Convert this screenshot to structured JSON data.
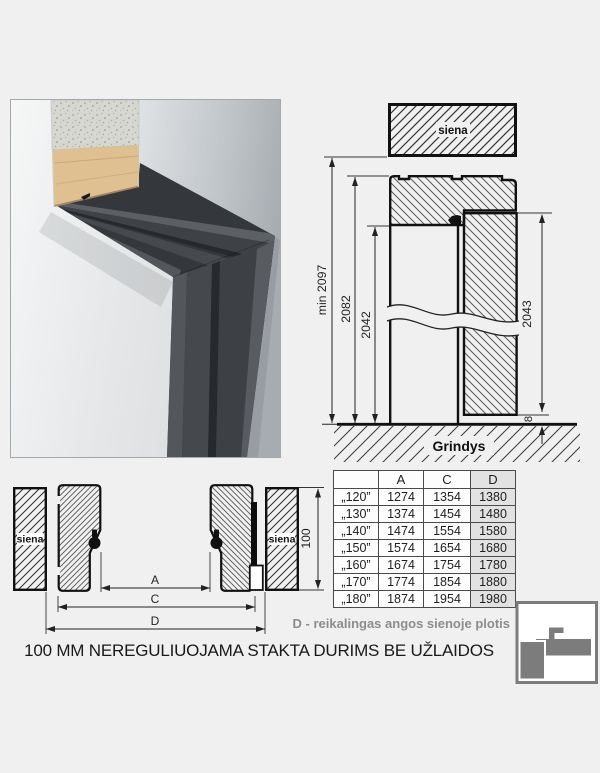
{
  "top_drawing": {
    "wall_label": "siena",
    "floor_label": "Grindys",
    "dim_min_height": "min 2097",
    "dim_frame_height": "2082",
    "dim_opening_height": "2042",
    "dim_leaf_height": "2043",
    "dim_floor_gap": "8"
  },
  "bottom_drawing": {
    "wall_label_left": "siena",
    "wall_label_right": "siena",
    "dim_a": "A",
    "dim_c": "C",
    "dim_d": "D",
    "dim_depth": "100"
  },
  "table": {
    "headers": [
      "",
      "A",
      "C",
      "D"
    ],
    "rows": [
      [
        "„120”",
        "1274",
        "1354",
        "1380"
      ],
      [
        "„130”",
        "1374",
        "1454",
        "1480"
      ],
      [
        "„140”",
        "1474",
        "1554",
        "1580"
      ],
      [
        "„150”",
        "1574",
        "1654",
        "1680"
      ],
      [
        "„160”",
        "1674",
        "1754",
        "1780"
      ],
      [
        "„170”",
        "1774",
        "1854",
        "1880"
      ],
      [
        "„180”",
        "1874",
        "1954",
        "1980"
      ]
    ]
  },
  "captions": {
    "d_note": "D - reikalingas angos sienoje plotis",
    "main": "100 MM NEREGULIUOJAMA STAKTA DURIMS BE UŽLAIDOS"
  },
  "colors": {
    "note_gray": "#8d8d8d",
    "logo_gray": "#7c7c7c",
    "table_d_bg": "#e2e2e2",
    "frame_dark": "#34383c"
  }
}
